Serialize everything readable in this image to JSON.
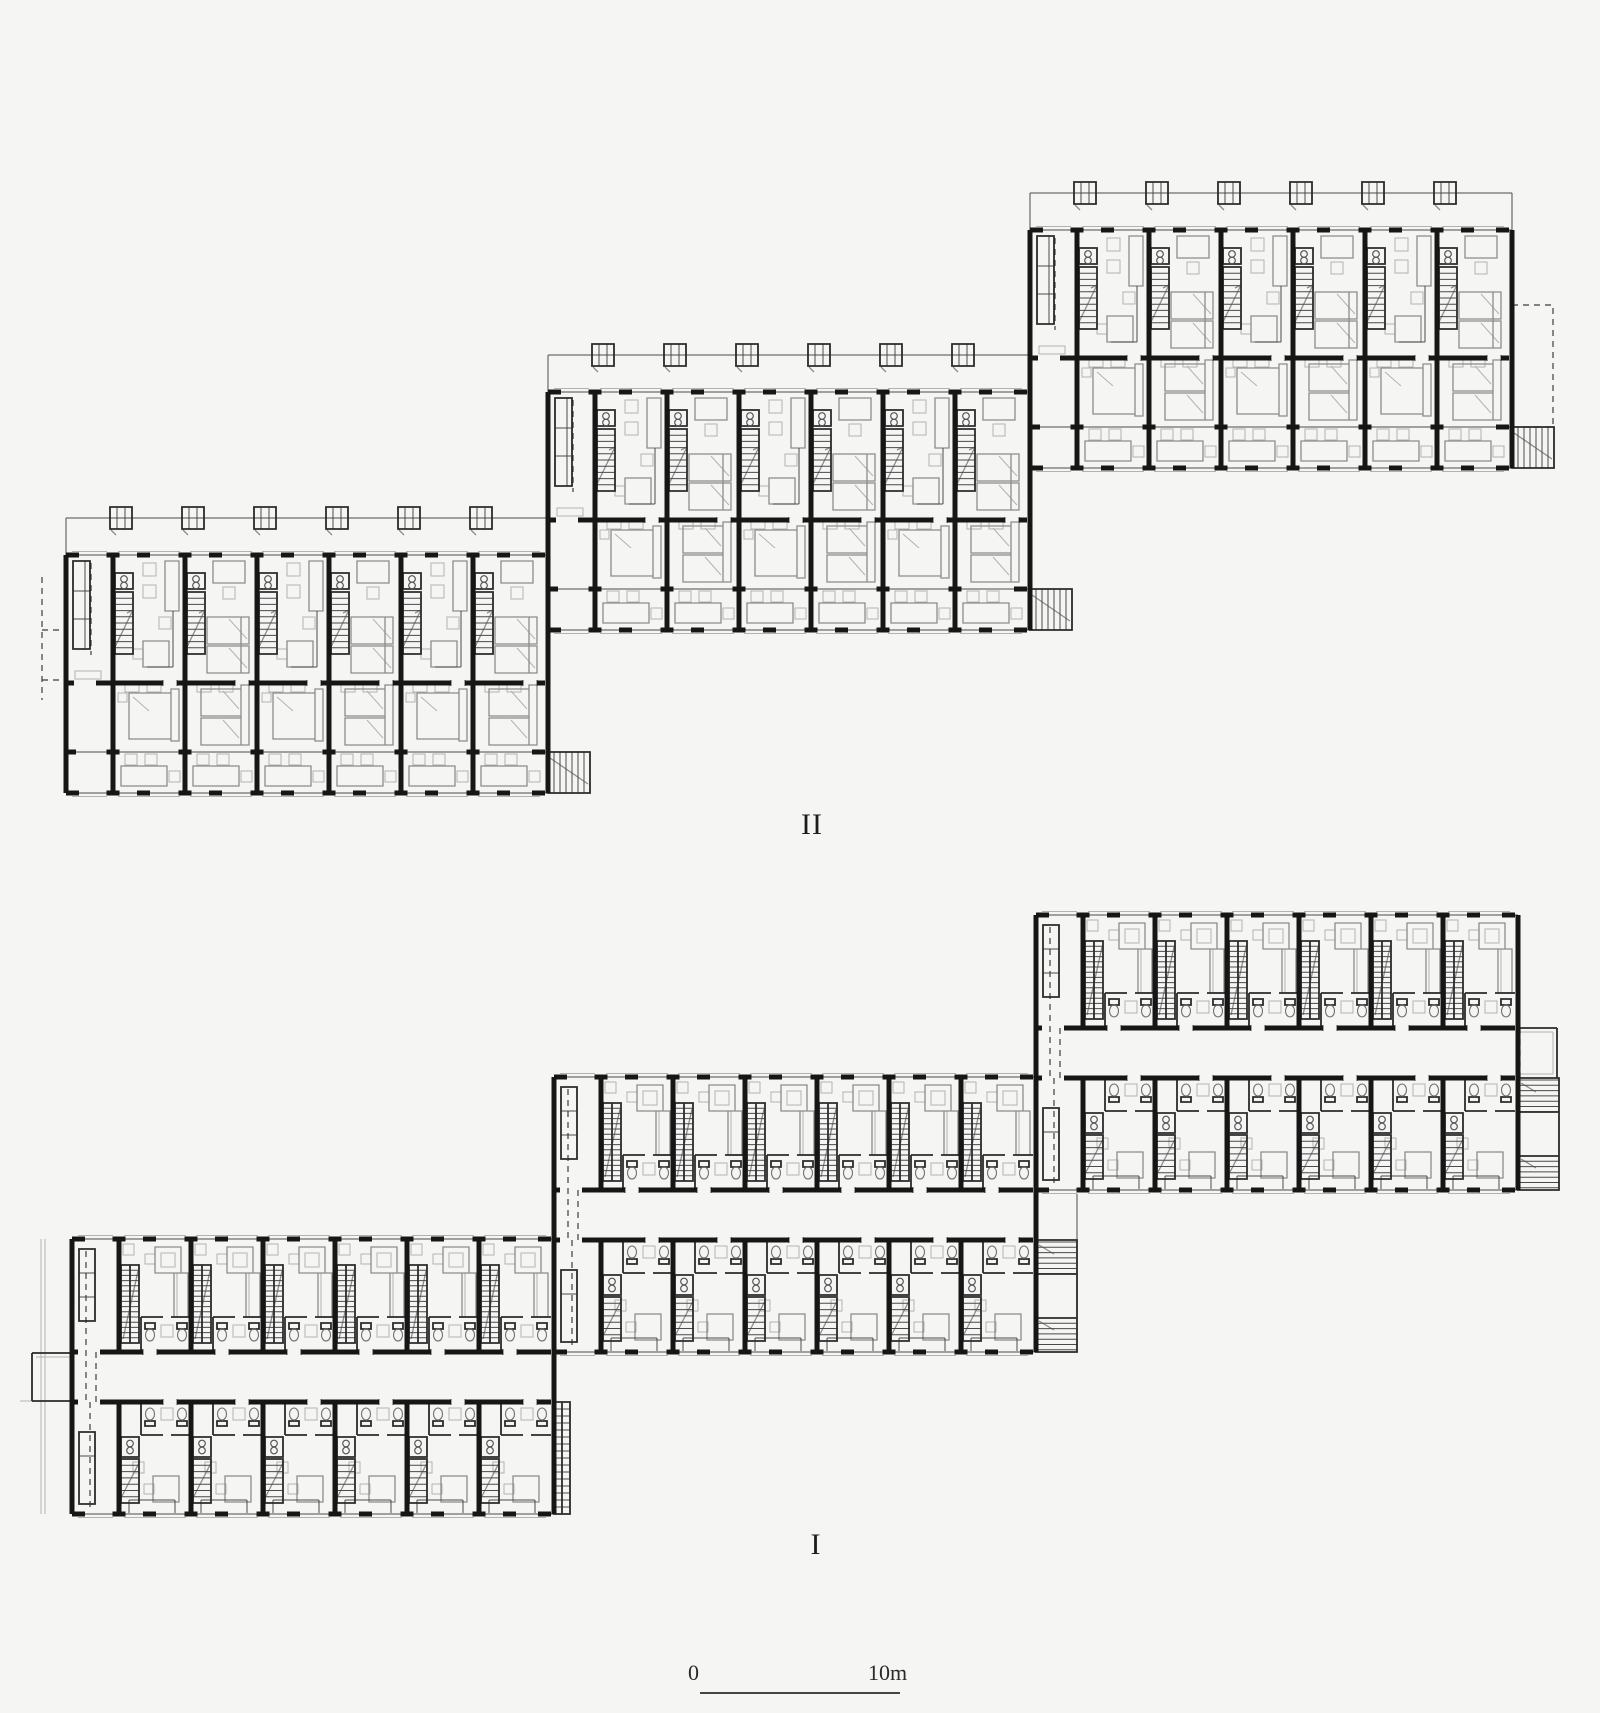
{
  "drawing": {
    "type": "architectural-floor-plans",
    "description": "Two stacked floor plans of a stepped terrace housing row; each plan is three offset rectangular blocks of repeated dwelling units with stairs, beds and bathrooms",
    "labels": {
      "upper": {
        "text": "II",
        "x": 812,
        "y": 808
      },
      "lower": {
        "text": "I",
        "x": 816,
        "y": 1528
      }
    },
    "scale_bar": {
      "zero": "0",
      "ten": "10m",
      "line_x1": 700,
      "line_x2": 900,
      "line_y": 1693,
      "zero_x": 688,
      "ten_x": 868,
      "label_y": 1660
    },
    "colors": {
      "background": "#f5f5f4",
      "wall": "#161616",
      "medium": "#2b2b2b",
      "thin": "#4a4a4a",
      "furniture": "#8c8c8c",
      "light": "#b2b2b2",
      "dashed": "#3c3c3c"
    },
    "plan_upper": {
      "name": "II",
      "metrics": {
        "width": 482,
        "height": 238,
        "row_offsets": [
          0,
          128,
          197,
          238
        ],
        "entry": 47,
        "bay": 72,
        "units": 6,
        "sky_dy": 37,
        "skybox": 22
      },
      "blocks": [
        {
          "id": "A",
          "x": 66,
          "y": 555,
          "dashed_left": true,
          "ext_stair": true
        },
        {
          "id": "B",
          "x": 548,
          "y": 392,
          "dashed_left": false,
          "ext_stair": true
        },
        {
          "id": "C",
          "x": 1030,
          "y": 230,
          "dashed_right": true,
          "ext_stair": true
        }
      ]
    },
    "plan_lower": {
      "name": "I",
      "metrics": {
        "width": 482,
        "upper": 113,
        "corr": 50,
        "lower": 112,
        "entry": 47,
        "bay": 72,
        "units": 6
      },
      "blocks": [
        {
          "id": "A",
          "x": 72,
          "y": 1239,
          "stub_left": true,
          "ext": "ladder",
          "balcony_left": true
        },
        {
          "id": "B",
          "x": 554,
          "y": 1077,
          "stub_left": false,
          "ext": "switchback"
        },
        {
          "id": "C",
          "x": 1036,
          "y": 915,
          "stub_right": true,
          "ext": "switchback"
        }
      ]
    }
  }
}
